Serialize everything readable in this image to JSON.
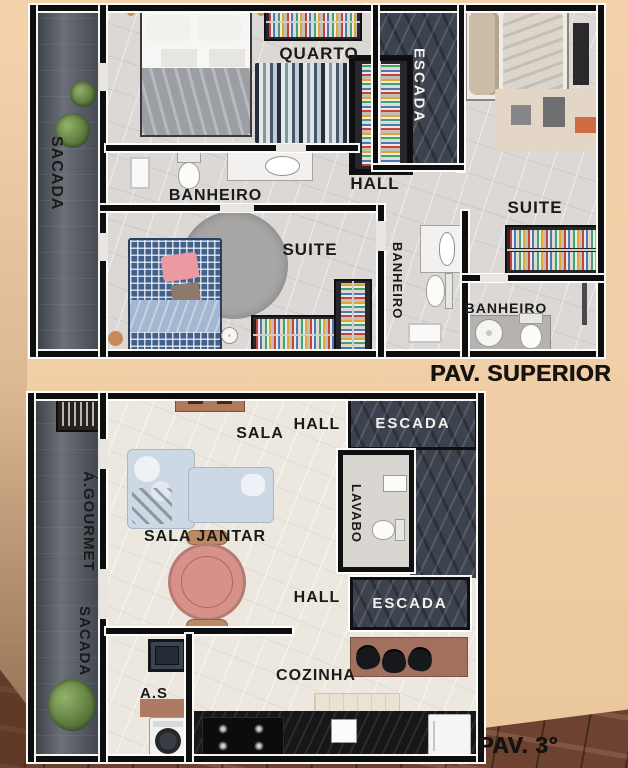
{
  "poster": {
    "caption_superior": "PAV. SUPERIOR",
    "caption_terceiro": "PAV. 3°"
  },
  "plan_superior": {
    "labels": {
      "sacada": "SACADA",
      "quarto": "QUARTO",
      "escada": "ESCADA",
      "banheiro_top": "BANHEIRO",
      "hall": "HALL",
      "suite_right": "SUITE",
      "suite_left": "SUITE",
      "banheiro_mid": "BANHEIRO",
      "banheiro_right": "BANHEIRO"
    }
  },
  "plan_terceiro": {
    "labels": {
      "area_gourmet": "Á.GOURMET",
      "sacada": "SACADA",
      "sala": "SALA",
      "hall_top": "HALL",
      "escada_top": "ESCADA",
      "lavabo": "LAVABO",
      "sala_jantar": "SALA JANTAR",
      "hall_bottom": "HALL",
      "escada_bottom": "ESCADA",
      "area_servico": "A.S",
      "cozinha": "COZINHA"
    }
  },
  "colors": {
    "background": "#f0cda6",
    "wood_floor": "#6d4230",
    "wall": "#0e0e0e",
    "wall_outline": "#ffffff",
    "floor_superior": "#dbd8d5",
    "floor_terceiro": "#ece8e0",
    "balcony": "#4d525a",
    "stairs": "#3d434e",
    "sofa": "#cdd8e5",
    "dining_table": "#d8918a",
    "bed_blue": "#41608c",
    "counter_brown": "#a2705f",
    "label_dark": "#1a1a1a",
    "label_light": "#f2f1ee"
  },
  "icons": [
    "plant-icon",
    "double-bed-icon",
    "single-bed-icon",
    "wardrobe-icon",
    "rug-icon",
    "toilet-icon",
    "sink-icon",
    "shower-icon",
    "sofa-icon",
    "dining-table-icon",
    "chair-icon",
    "console-icon",
    "grill-icon",
    "laundry-sink-icon",
    "washing-machine-icon",
    "stove-icon",
    "fridge-icon",
    "kitchen-island-icon",
    "counter-icon",
    "nightstand-icon"
  ]
}
